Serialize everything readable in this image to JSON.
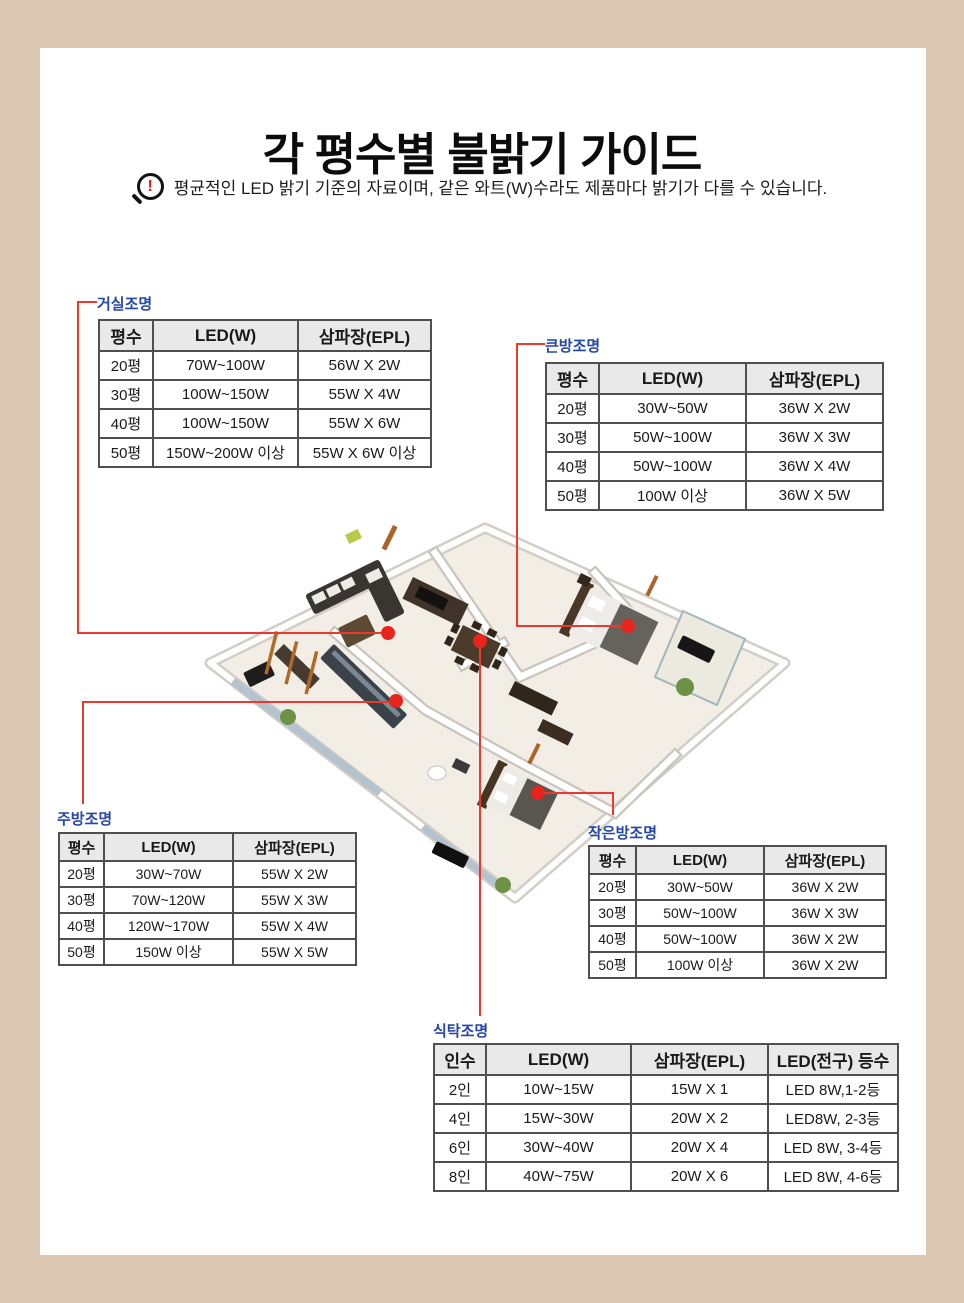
{
  "page": {
    "title": "각 평수별 불밝기 가이드",
    "notice": {
      "icon": "magnifier-alert-icon",
      "icon_glyph": "!",
      "text": "평균적인 LED 밝기 기준의 자료이며, 같은 와트(W)수라도 제품마다 밝기가 다를 수 있습니다."
    }
  },
  "colors": {
    "frame_tan": "#dcc7b2",
    "content_white": "#ffffff",
    "accent_red_dot": "#e7251d",
    "accent_red_line": "#ea3a30",
    "label_blue": "#2646a8",
    "table_header_bg": "#e9e9e9",
    "table_border": "#4f4f4f"
  },
  "floorplan": {
    "description": "3D isometric apartment rendering with five red location markers",
    "marked_rooms": [
      "거실",
      "큰방",
      "주방",
      "작은방",
      "식탁"
    ]
  },
  "tables": [
    {
      "id": "living",
      "label": "거실조명",
      "headers": [
        "평수",
        "LED(W)",
        "삼파장(EPL)"
      ],
      "rows": [
        [
          "20평",
          "70W~100W",
          "56W X 2W"
        ],
        [
          "30평",
          "100W~150W",
          "55W X 4W"
        ],
        [
          "40평",
          "100W~150W",
          "55W X 6W"
        ],
        [
          "50평",
          "150W~200W 이상",
          "55W X 6W 이상"
        ]
      ]
    },
    {
      "id": "bigroom",
      "label": "큰방조명",
      "headers": [
        "평수",
        "LED(W)",
        "삼파장(EPL)"
      ],
      "rows": [
        [
          "20평",
          "30W~50W",
          "36W X 2W"
        ],
        [
          "30평",
          "50W~100W",
          "36W X 3W"
        ],
        [
          "40평",
          "50W~100W",
          "36W X 4W"
        ],
        [
          "50평",
          "100W 이상",
          "36W X 5W"
        ]
      ]
    },
    {
      "id": "kitchen",
      "label": "주방조명",
      "headers": [
        "평수",
        "LED(W)",
        "삼파장(EPL)"
      ],
      "rows": [
        [
          "20평",
          "30W~70W",
          "55W X 2W"
        ],
        [
          "30평",
          "70W~120W",
          "55W X 3W"
        ],
        [
          "40평",
          "120W~170W",
          "55W X 4W"
        ],
        [
          "50평",
          "150W 이상",
          "55W X 5W"
        ]
      ]
    },
    {
      "id": "smallroom",
      "label": "작은방조명",
      "headers": [
        "평수",
        "LED(W)",
        "삼파장(EPL)"
      ],
      "rows": [
        [
          "20평",
          "30W~50W",
          "36W X 2W"
        ],
        [
          "30평",
          "50W~100W",
          "36W X 3W"
        ],
        [
          "40평",
          "50W~100W",
          "36W X 2W"
        ],
        [
          "50평",
          "100W 이상",
          "36W X 2W"
        ]
      ]
    },
    {
      "id": "dining",
      "label": "식탁조명",
      "headers": [
        "인수",
        "LED(W)",
        "삼파장(EPL)",
        "LED(전구) 등수"
      ],
      "rows": [
        [
          "2인",
          "10W~15W",
          "15W X 1",
          "LED 8W,1-2등"
        ],
        [
          "4인",
          "15W~30W",
          "20W X 2",
          "LED8W, 2-3등"
        ],
        [
          "6인",
          "30W~40W",
          "20W X 4",
          "LED 8W, 3-4등"
        ],
        [
          "8인",
          "40W~75W",
          "20W X 6",
          "LED 8W, 4-6등"
        ]
      ]
    }
  ]
}
